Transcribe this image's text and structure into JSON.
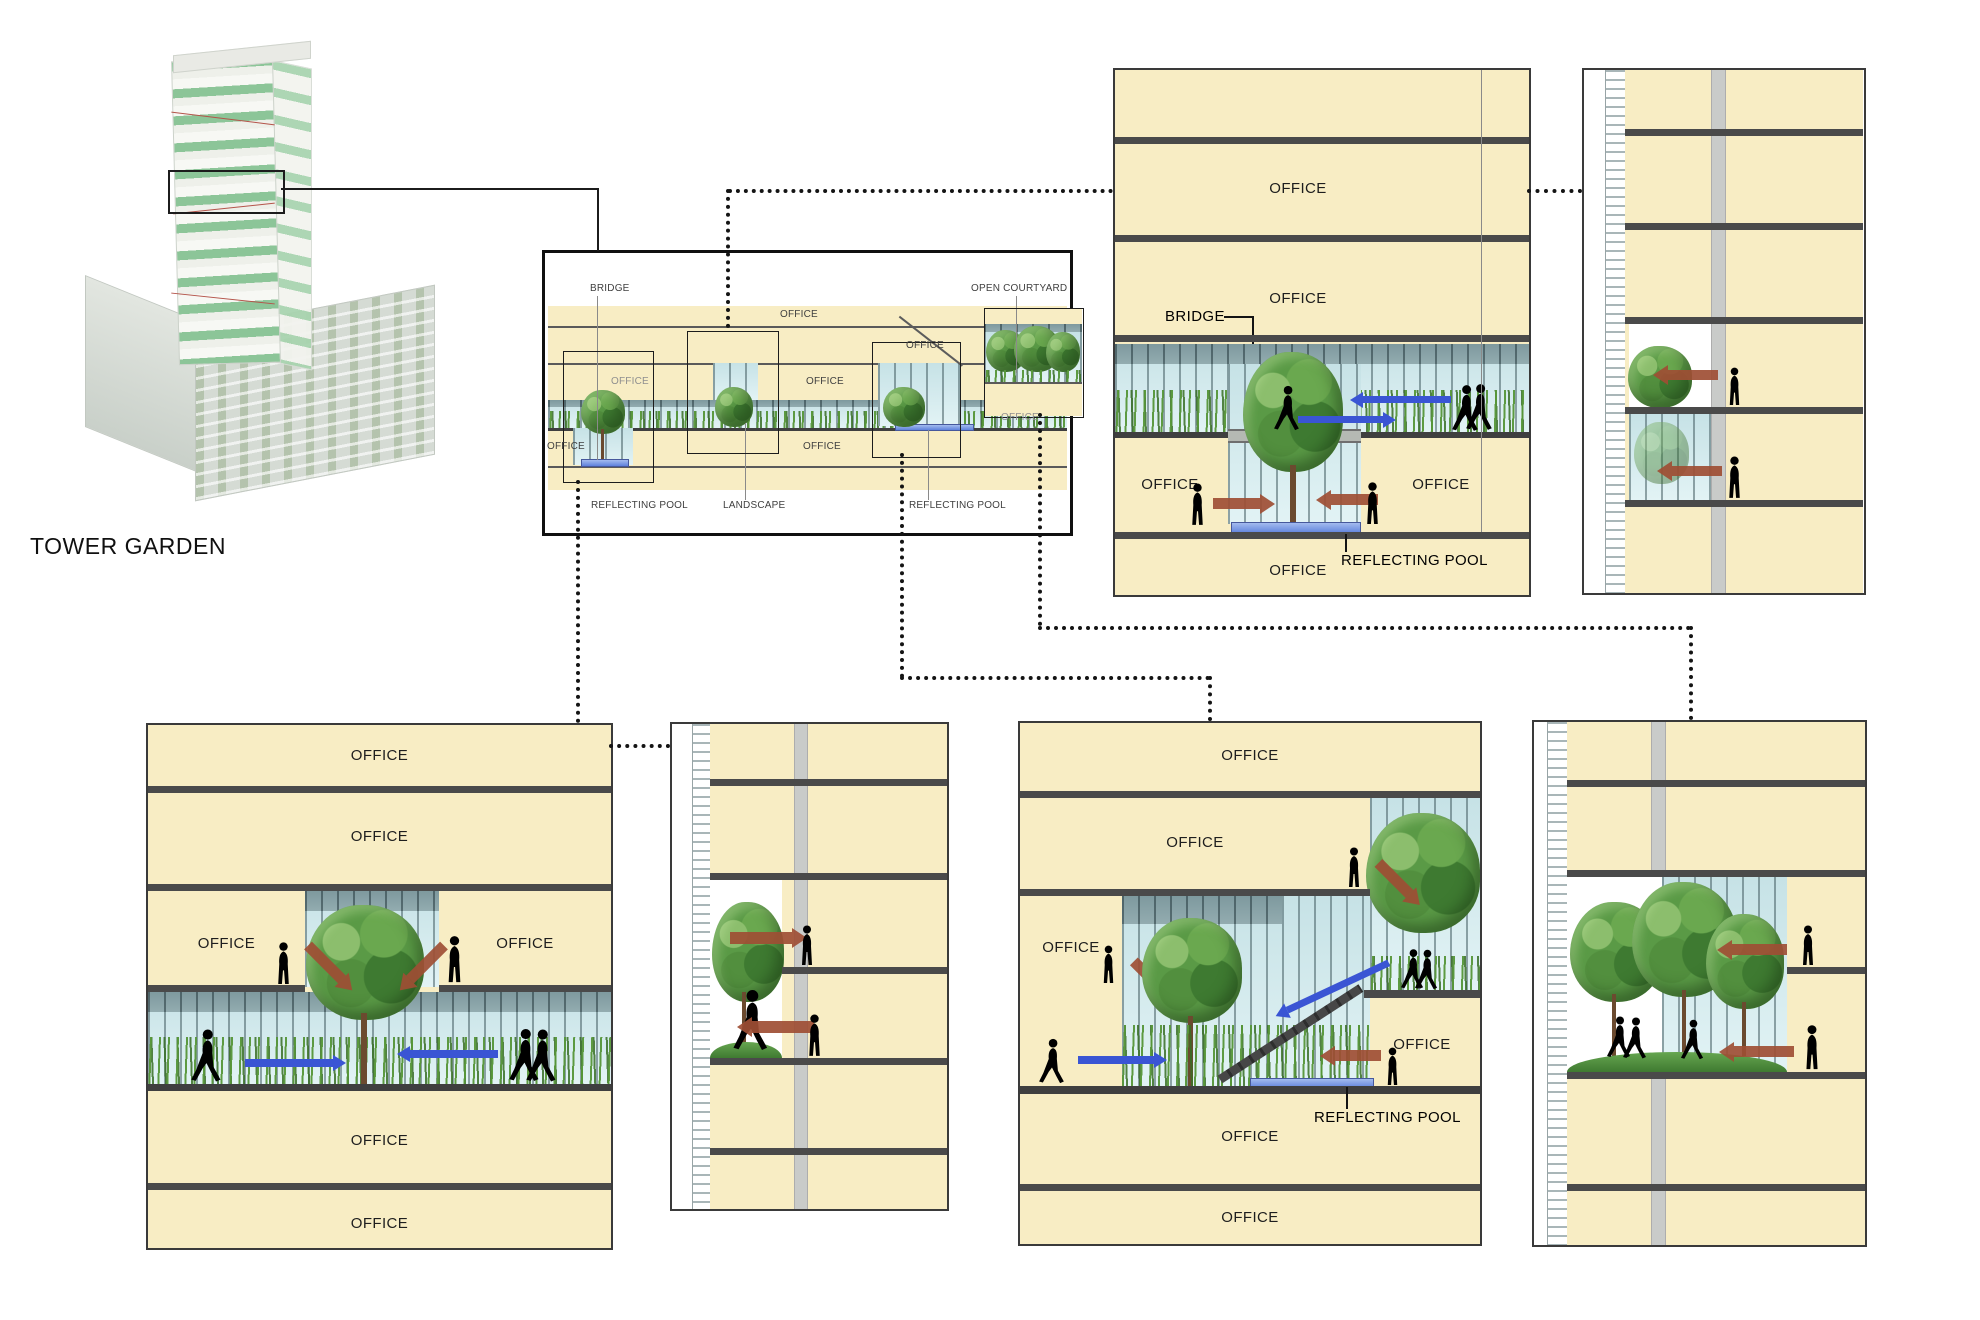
{
  "title": "TOWER GARDEN",
  "colors": {
    "floor_yellow": "#F8EDC4",
    "slab_gray": "#4A4A4A",
    "glass_light": "#D8EEF1",
    "glass_dark": "#8AA4A8",
    "water_blue": "#5F82DC",
    "flow_arrow_blue": "#3A55D4",
    "view_arrow_red": "#9E4E34",
    "grass_green": "#4C8A3C",
    "tree_green": "#5A9A46",
    "tower_plate_green": "#8CC598"
  },
  "overview": {
    "labels": {
      "bridge": "BRIDGE",
      "office_top": "OFFICE",
      "open_courtyard": "OPEN COURTYARD",
      "office_upper_right": "OFFICE",
      "office_mid_left": "OFFICE",
      "office_mid_center": "OFFICE",
      "office_lower_left": "OFFICE",
      "office_lower_center": "OFFICE",
      "office_courtyard": "OFFICE",
      "reflecting_pool_left": "REFLECTING POOL",
      "landscape": "LANDSCAPE",
      "reflecting_pool_right": "REFLECTING POOL"
    }
  },
  "section_a": {
    "labels": {
      "office_f2": "OFFICE",
      "office_f3": "OFFICE",
      "bridge": "BRIDGE",
      "office_left": "OFFICE",
      "office_right": "OFFICE",
      "reflecting_pool": "REFLECTING POOL",
      "office_bottom": "OFFICE"
    }
  },
  "section_c": {
    "labels": {
      "office_f1": "OFFICE",
      "office_f2": "OFFICE",
      "office_left": "OFFICE",
      "office_right": "OFFICE",
      "office_f4": "OFFICE",
      "office_f5": "OFFICE"
    }
  },
  "section_d": {
    "labels": {
      "office_f1": "OFFICE",
      "office_f2": "OFFICE",
      "office_left": "OFFICE",
      "office_right": "OFFICE",
      "reflecting_pool": "REFLECTING POOL",
      "office_f4": "OFFICE",
      "office_f5": "OFFICE"
    }
  }
}
